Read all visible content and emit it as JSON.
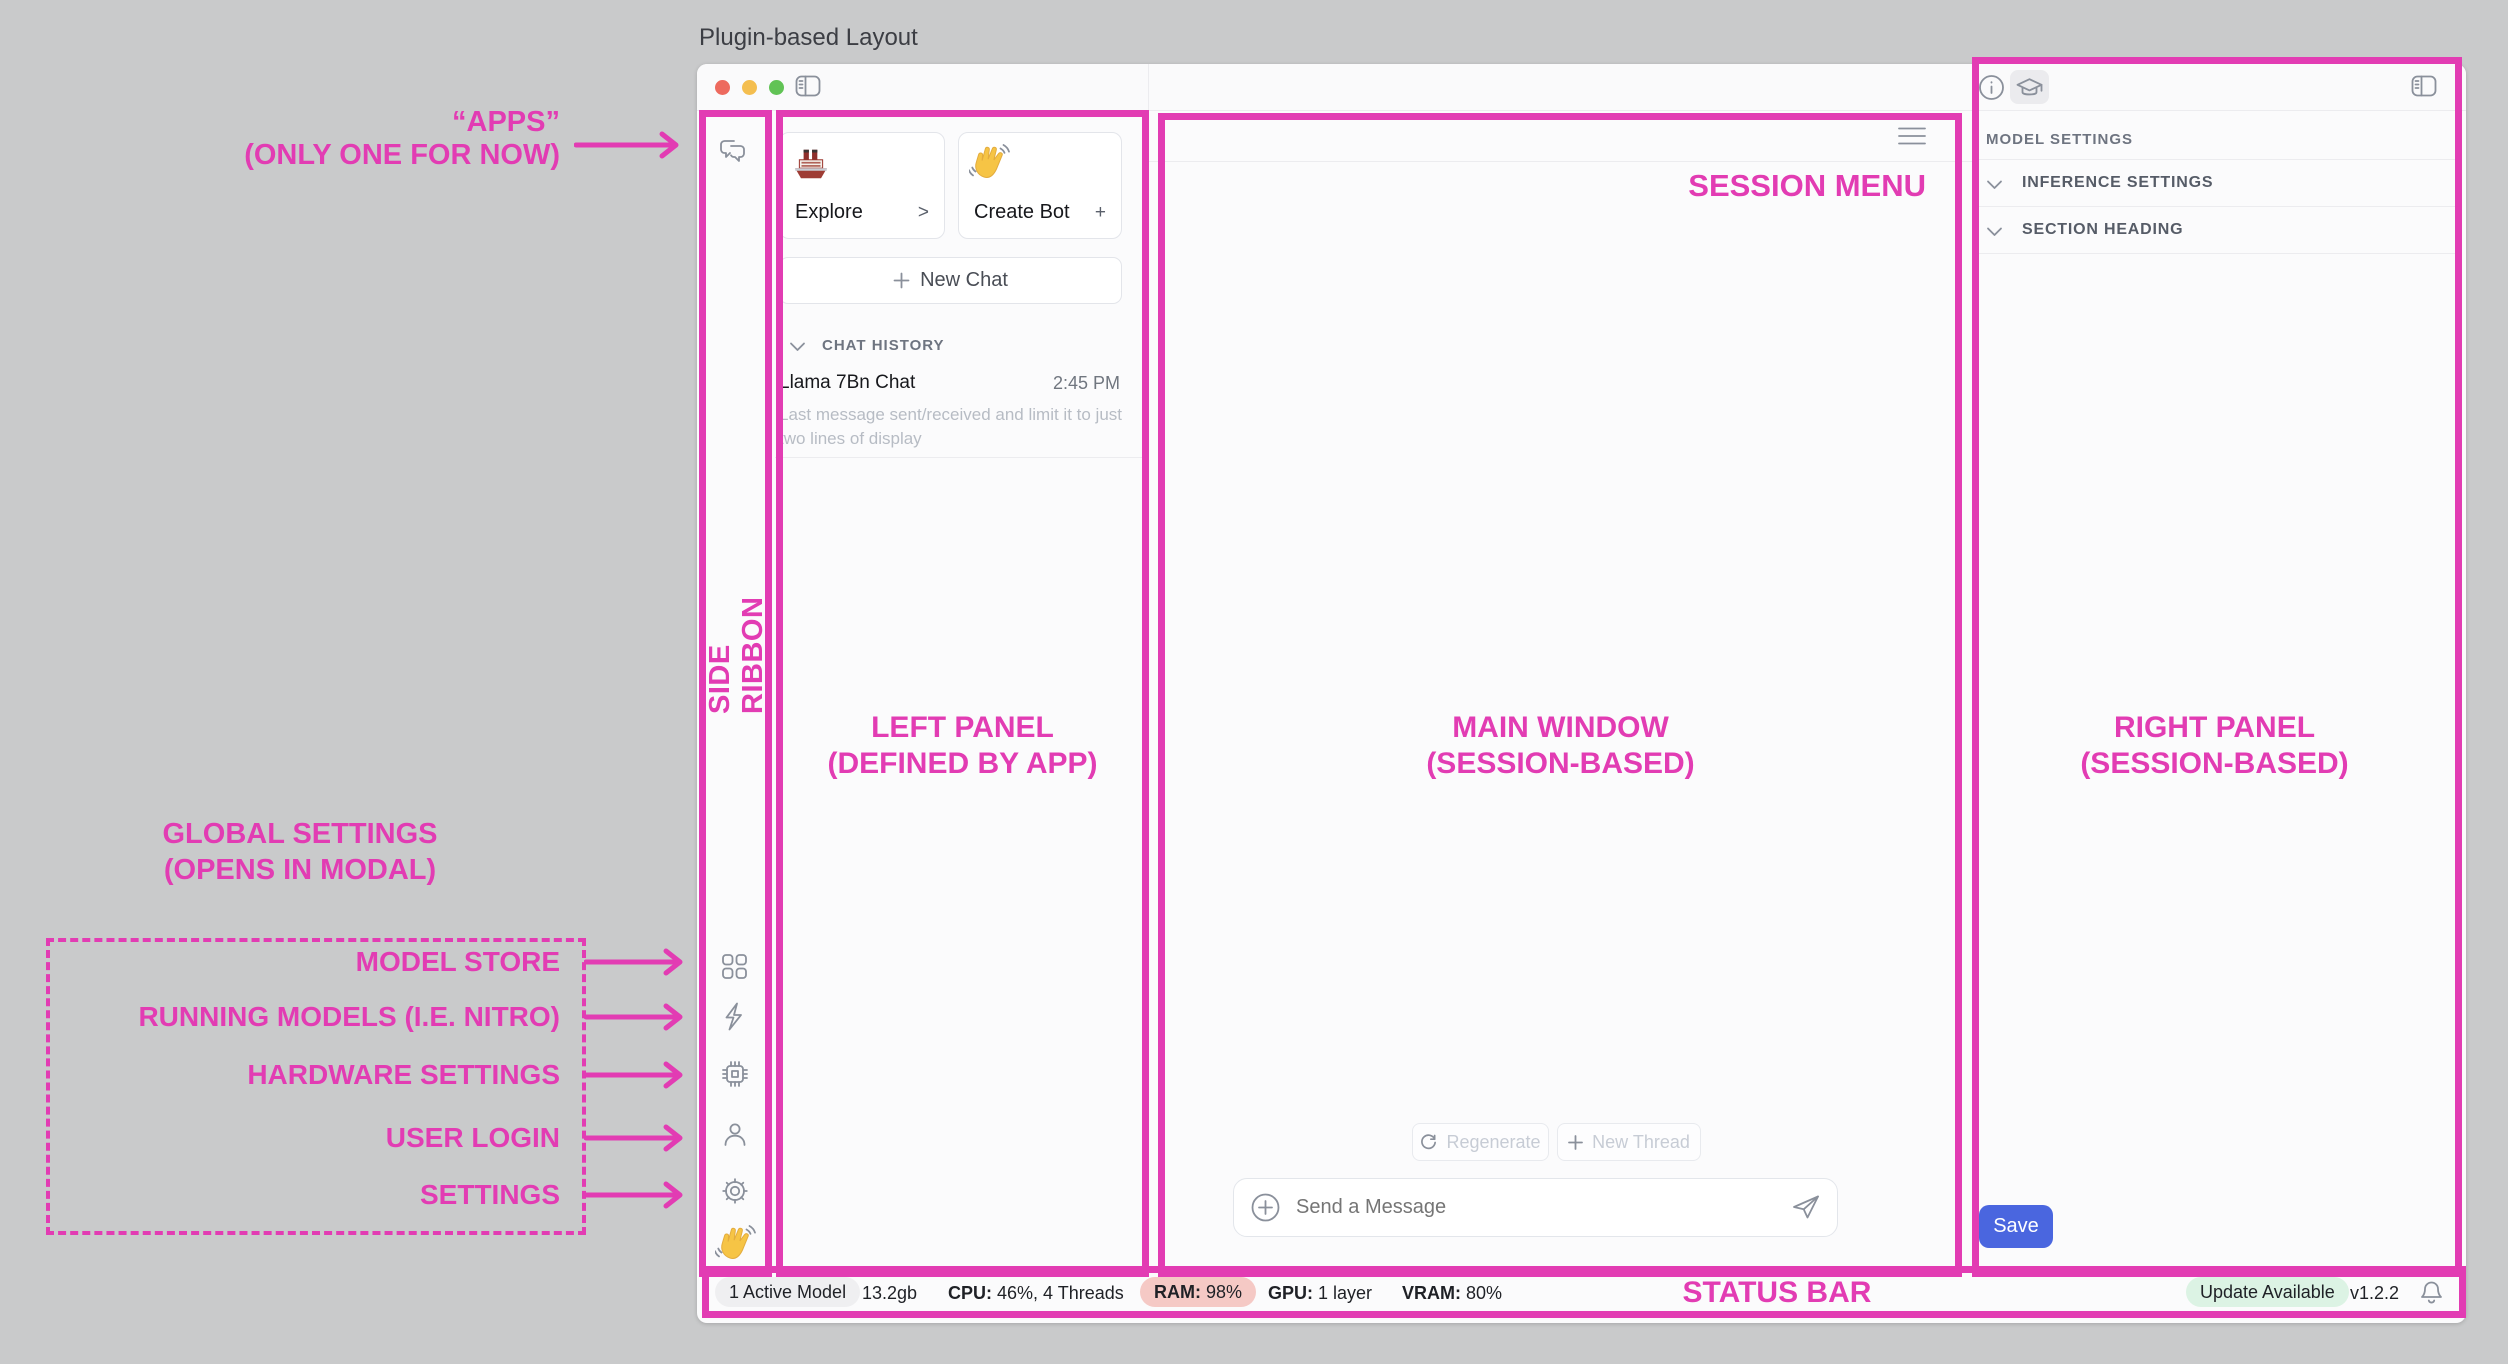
{
  "page_title": "Plugin-based Layout",
  "colors": {
    "annotation_magenta": "#E23CB3",
    "save_blue": "#4A66DF",
    "ram_pill": "#F5C9C5",
    "update_pill": "#DCF3E4",
    "neutral_pill": "#EFEFF1",
    "traffic_red": "#ED6A5E",
    "traffic_yellow": "#F4BE4F",
    "traffic_green": "#61C355"
  },
  "annotations": {
    "apps": {
      "line1": "“APPS”",
      "line2": "(ONLY ONE FOR NOW)"
    },
    "side_ribbon": "SIDE RIBBON",
    "left_panel": {
      "line1": "LEFT PANEL",
      "line2": "(DEFINED BY APP)"
    },
    "main_window": {
      "line1": "MAIN WINDOW",
      "line2": "(SESSION-BASED)"
    },
    "right_panel": {
      "line1": "RIGHT PANEL",
      "line2": "(SESSION-BASED)"
    },
    "session_menu": "SESSION MENU",
    "status_bar": "STATUS BAR",
    "global_settings": {
      "line1": "GLOBAL SETTINGS",
      "line2": "(OPENS IN MODAL)"
    },
    "ribbon_items": [
      "MODEL STORE",
      "RUNNING MODELS (I.E. NITRO)",
      "HARDWARE SETTINGS",
      "USER LOGIN",
      "SETTINGS"
    ]
  },
  "left_panel": {
    "cards": [
      {
        "icon": "ship-icon",
        "label": "Explore",
        "accessory": ">"
      },
      {
        "icon": "wave-icon",
        "label": "Create Bot",
        "accessory": "+"
      }
    ],
    "new_chat_label": "New Chat",
    "history_header": "CHAT HISTORY",
    "chat": {
      "title": "Llama 7Bn Chat",
      "time": "2:45 PM",
      "preview": "Last message sent/received and limit it to just two lines of display"
    }
  },
  "main": {
    "regenerate_label": "Regenerate",
    "new_thread_label": "New Thread",
    "composer_placeholder": "Send a Message"
  },
  "right_panel": {
    "header": "MODEL SETTINGS",
    "sections": [
      {
        "label": "INFERENCE SETTINGS"
      },
      {
        "label": "SECTION HEADING"
      }
    ],
    "save_label": "Save"
  },
  "status_bar": {
    "active_model": "1 Active Model",
    "memory": "13.2gb",
    "cpu_label": "CPU:",
    "cpu_value": "46%, 4 Threads",
    "ram_label": "RAM:",
    "ram_value": "98%",
    "gpu_label": "GPU:",
    "gpu_value": "1 layer",
    "vram_label": "VRAM:",
    "vram_value": "80%",
    "update_badge": "Update Available",
    "version": "v1.2.2"
  }
}
